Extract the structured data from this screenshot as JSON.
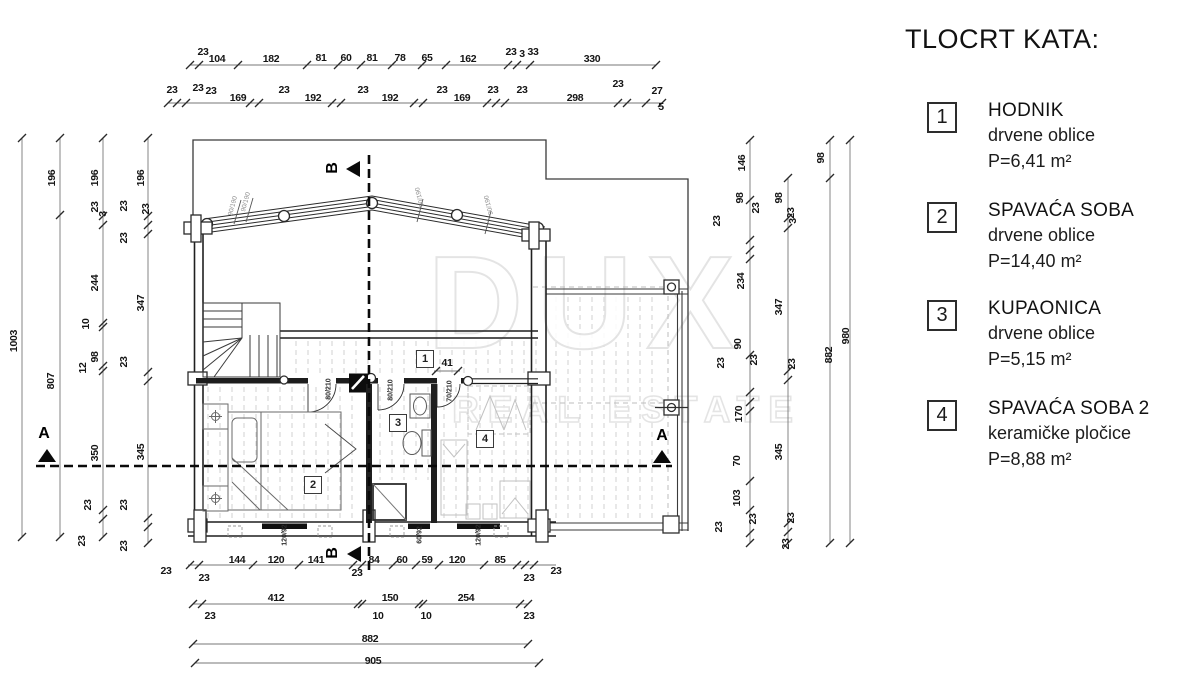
{
  "legend": {
    "title": "TLOCRT KATA:",
    "items": [
      {
        "num": "1",
        "name": "HODNIK",
        "finish": "drvene oblice",
        "area": "P=6,41 m²"
      },
      {
        "num": "2",
        "name": "SPAVAĆA SOBA",
        "finish": "drvene oblice",
        "area": "P=14,40 m²"
      },
      {
        "num": "3",
        "name": "KUPAONICA",
        "finish": "drvene oblice",
        "area": "P=5,15 m²"
      },
      {
        "num": "4",
        "name": "SPAVAĆA SOBA 2",
        "finish": "keramičke pločice",
        "area": "P=8,88 m²"
      }
    ]
  },
  "watermark": {
    "line1": "DUX",
    "line2": "REAL ESTATE"
  },
  "plan": {
    "room_numbers": [
      "1",
      "2",
      "3",
      "4"
    ]
  },
  "annotations": [
    {
      "t": "23",
      "x": 203,
      "y": 52
    },
    {
      "t": "104",
      "x": 217,
      "y": 59
    },
    {
      "t": "182",
      "x": 271,
      "y": 59
    },
    {
      "t": "81",
      "x": 321,
      "y": 58
    },
    {
      "t": "60",
      "x": 346,
      "y": 58
    },
    {
      "t": "81",
      "x": 372,
      "y": 58
    },
    {
      "t": "78",
      "x": 400,
      "y": 58
    },
    {
      "t": "65",
      "x": 427,
      "y": 58
    },
    {
      "t": "162",
      "x": 468,
      "y": 59
    },
    {
      "t": "23",
      "x": 511,
      "y": 52
    },
    {
      "t": "3",
      "x": 522,
      "y": 54
    },
    {
      "t": "33",
      "x": 533,
      "y": 52
    },
    {
      "t": "330",
      "x": 592,
      "y": 59
    },
    {
      "t": "23",
      "x": 172,
      "y": 90
    },
    {
      "t": "23",
      "x": 198,
      "y": 88
    },
    {
      "t": "23",
      "x": 211,
      "y": 91
    },
    {
      "t": "169",
      "x": 238,
      "y": 98
    },
    {
      "t": "23",
      "x": 284,
      "y": 90
    },
    {
      "t": "192",
      "x": 313,
      "y": 98
    },
    {
      "t": "23",
      "x": 363,
      "y": 90
    },
    {
      "t": "192",
      "x": 390,
      "y": 98
    },
    {
      "t": "23",
      "x": 442,
      "y": 90
    },
    {
      "t": "169",
      "x": 462,
      "y": 98
    },
    {
      "t": "23",
      "x": 493,
      "y": 90
    },
    {
      "t": "23",
      "x": 522,
      "y": 90
    },
    {
      "t": "298",
      "x": 575,
      "y": 98
    },
    {
      "t": "23",
      "x": 618,
      "y": 84
    },
    {
      "t": "27",
      "x": 657,
      "y": 91
    },
    {
      "t": "5",
      "x": 661,
      "y": 107
    },
    {
      "t": "23",
      "x": 166,
      "y": 571
    },
    {
      "t": "23",
      "x": 204,
      "y": 578
    },
    {
      "t": "144",
      "x": 237,
      "y": 560
    },
    {
      "t": "120",
      "x": 276,
      "y": 560
    },
    {
      "t": "141",
      "x": 316,
      "y": 560
    },
    {
      "t": "23",
      "x": 357,
      "y": 573
    },
    {
      "t": "84",
      "x": 374,
      "y": 560
    },
    {
      "t": "60",
      "x": 402,
      "y": 560
    },
    {
      "t": "59",
      "x": 427,
      "y": 560
    },
    {
      "t": "120",
      "x": 457,
      "y": 560
    },
    {
      "t": "85",
      "x": 500,
      "y": 560
    },
    {
      "t": "23",
      "x": 529,
      "y": 578
    },
    {
      "t": "23",
      "x": 556,
      "y": 571
    },
    {
      "t": "23",
      "x": 210,
      "y": 616
    },
    {
      "t": "412",
      "x": 276,
      "y": 598
    },
    {
      "t": "10",
      "x": 378,
      "y": 616
    },
    {
      "t": "150",
      "x": 390,
      "y": 598
    },
    {
      "t": "10",
      "x": 426,
      "y": 616
    },
    {
      "t": "254",
      "x": 466,
      "y": 598
    },
    {
      "t": "23",
      "x": 529,
      "y": 616
    },
    {
      "t": "882",
      "x": 370,
      "y": 639
    },
    {
      "t": "905",
      "x": 373,
      "y": 661
    },
    {
      "t": "1003",
      "x": 14,
      "y": 341,
      "r": -90
    },
    {
      "t": "196",
      "x": 52,
      "y": 178,
      "r": -90
    },
    {
      "t": "807",
      "x": 51,
      "y": 381,
      "r": -90
    },
    {
      "t": "196",
      "x": 95,
      "y": 178,
      "r": -90
    },
    {
      "t": "23",
      "x": 95,
      "y": 207,
      "r": -90
    },
    {
      "t": "3",
      "x": 103,
      "y": 214,
      "r": -90
    },
    {
      "t": "244",
      "x": 95,
      "y": 283,
      "r": -90
    },
    {
      "t": "10",
      "x": 86,
      "y": 324,
      "r": -90
    },
    {
      "t": "98",
      "x": 95,
      "y": 357,
      "r": -90
    },
    {
      "t": "12",
      "x": 83,
      "y": 368,
      "r": -90
    },
    {
      "t": "350",
      "x": 95,
      "y": 453,
      "r": -90
    },
    {
      "t": "23",
      "x": 88,
      "y": 505,
      "r": -90
    },
    {
      "t": "23",
      "x": 82,
      "y": 541,
      "r": -90
    },
    {
      "t": "196",
      "x": 141,
      "y": 178,
      "r": -90
    },
    {
      "t": "23",
      "x": 124,
      "y": 206,
      "r": -90
    },
    {
      "t": "23",
      "x": 146,
      "y": 209,
      "r": -90
    },
    {
      "t": "23",
      "x": 124,
      "y": 238,
      "r": -90
    },
    {
      "t": "347",
      "x": 141,
      "y": 303,
      "r": -90
    },
    {
      "t": "23",
      "x": 124,
      "y": 362,
      "r": -90
    },
    {
      "t": "345",
      "x": 141,
      "y": 452,
      "r": -90
    },
    {
      "t": "23",
      "x": 124,
      "y": 505,
      "r": -90
    },
    {
      "t": "23",
      "x": 124,
      "y": 546,
      "r": -90
    },
    {
      "t": "146",
      "x": 742,
      "y": 163,
      "r": -90
    },
    {
      "t": "98",
      "x": 740,
      "y": 198,
      "r": -90
    },
    {
      "t": "23",
      "x": 717,
      "y": 221,
      "r": -90
    },
    {
      "t": "23",
      "x": 756,
      "y": 208,
      "r": -90
    },
    {
      "t": "234",
      "x": 741,
      "y": 281,
      "r": -90
    },
    {
      "t": "90",
      "x": 738,
      "y": 344,
      "r": -90
    },
    {
      "t": "23",
      "x": 721,
      "y": 363,
      "r": -90
    },
    {
      "t": "23",
      "x": 754,
      "y": 360,
      "r": -90
    },
    {
      "t": "170",
      "x": 739,
      "y": 414,
      "r": -90
    },
    {
      "t": "70",
      "x": 737,
      "y": 461,
      "r": -90
    },
    {
      "t": "103",
      "x": 737,
      "y": 498,
      "r": -90
    },
    {
      "t": "23",
      "x": 719,
      "y": 527,
      "r": -90
    },
    {
      "t": "23",
      "x": 753,
      "y": 519,
      "r": -90
    },
    {
      "t": "98",
      "x": 779,
      "y": 198,
      "r": -90
    },
    {
      "t": "23",
      "x": 791,
      "y": 213,
      "r": -90
    },
    {
      "t": "3",
      "x": 793,
      "y": 221,
      "r": -90
    },
    {
      "t": "347",
      "x": 779,
      "y": 307,
      "r": -90
    },
    {
      "t": "23",
      "x": 792,
      "y": 364,
      "r": -90
    },
    {
      "t": "345",
      "x": 779,
      "y": 452,
      "r": -90
    },
    {
      "t": "23",
      "x": 791,
      "y": 518,
      "r": -90
    },
    {
      "t": "23",
      "x": 786,
      "y": 544,
      "r": -90
    },
    {
      "t": "98",
      "x": 821,
      "y": 158,
      "r": -90
    },
    {
      "t": "882",
      "x": 829,
      "y": 355,
      "r": -90
    },
    {
      "t": "980",
      "x": 846,
      "y": 336,
      "r": -90
    },
    {
      "t": "41",
      "x": 447,
      "y": 363
    },
    {
      "t": "80/210",
      "x": 329,
      "y": 389,
      "r": -90,
      "c": "s"
    },
    {
      "t": "80/210",
      "x": 391,
      "y": 390,
      "r": -90,
      "c": "s"
    },
    {
      "t": "70/210",
      "x": 450,
      "y": 391,
      "r": -90,
      "c": "s"
    },
    {
      "t": "120/92",
      "x": 285,
      "y": 535,
      "r": -90,
      "c": "s"
    },
    {
      "t": "60/92",
      "x": 420,
      "y": 535,
      "r": -90,
      "c": "s"
    },
    {
      "t": "120/92",
      "x": 479,
      "y": 535,
      "r": -90,
      "c": "s"
    },
    {
      "t": "90/190",
      "x": 233,
      "y": 206,
      "r": -75,
      "c": "g"
    },
    {
      "t": "90/190",
      "x": 246,
      "y": 202,
      "r": -75,
      "c": "g"
    },
    {
      "t": "90/190",
      "x": 420,
      "y": 197,
      "r": -105,
      "c": "g"
    },
    {
      "t": "90/190",
      "x": 489,
      "y": 205,
      "r": -105,
      "c": "g"
    },
    {
      "t": "A",
      "x": 44,
      "y": 434,
      "c": "sec"
    },
    {
      "t": "A",
      "x": 662,
      "y": 436,
      "c": "sec"
    },
    {
      "t": "B",
      "x": 333,
      "y": 168,
      "r": -90,
      "c": "sec"
    },
    {
      "t": "B",
      "x": 333,
      "y": 553,
      "r": -90,
      "c": "sec"
    }
  ]
}
